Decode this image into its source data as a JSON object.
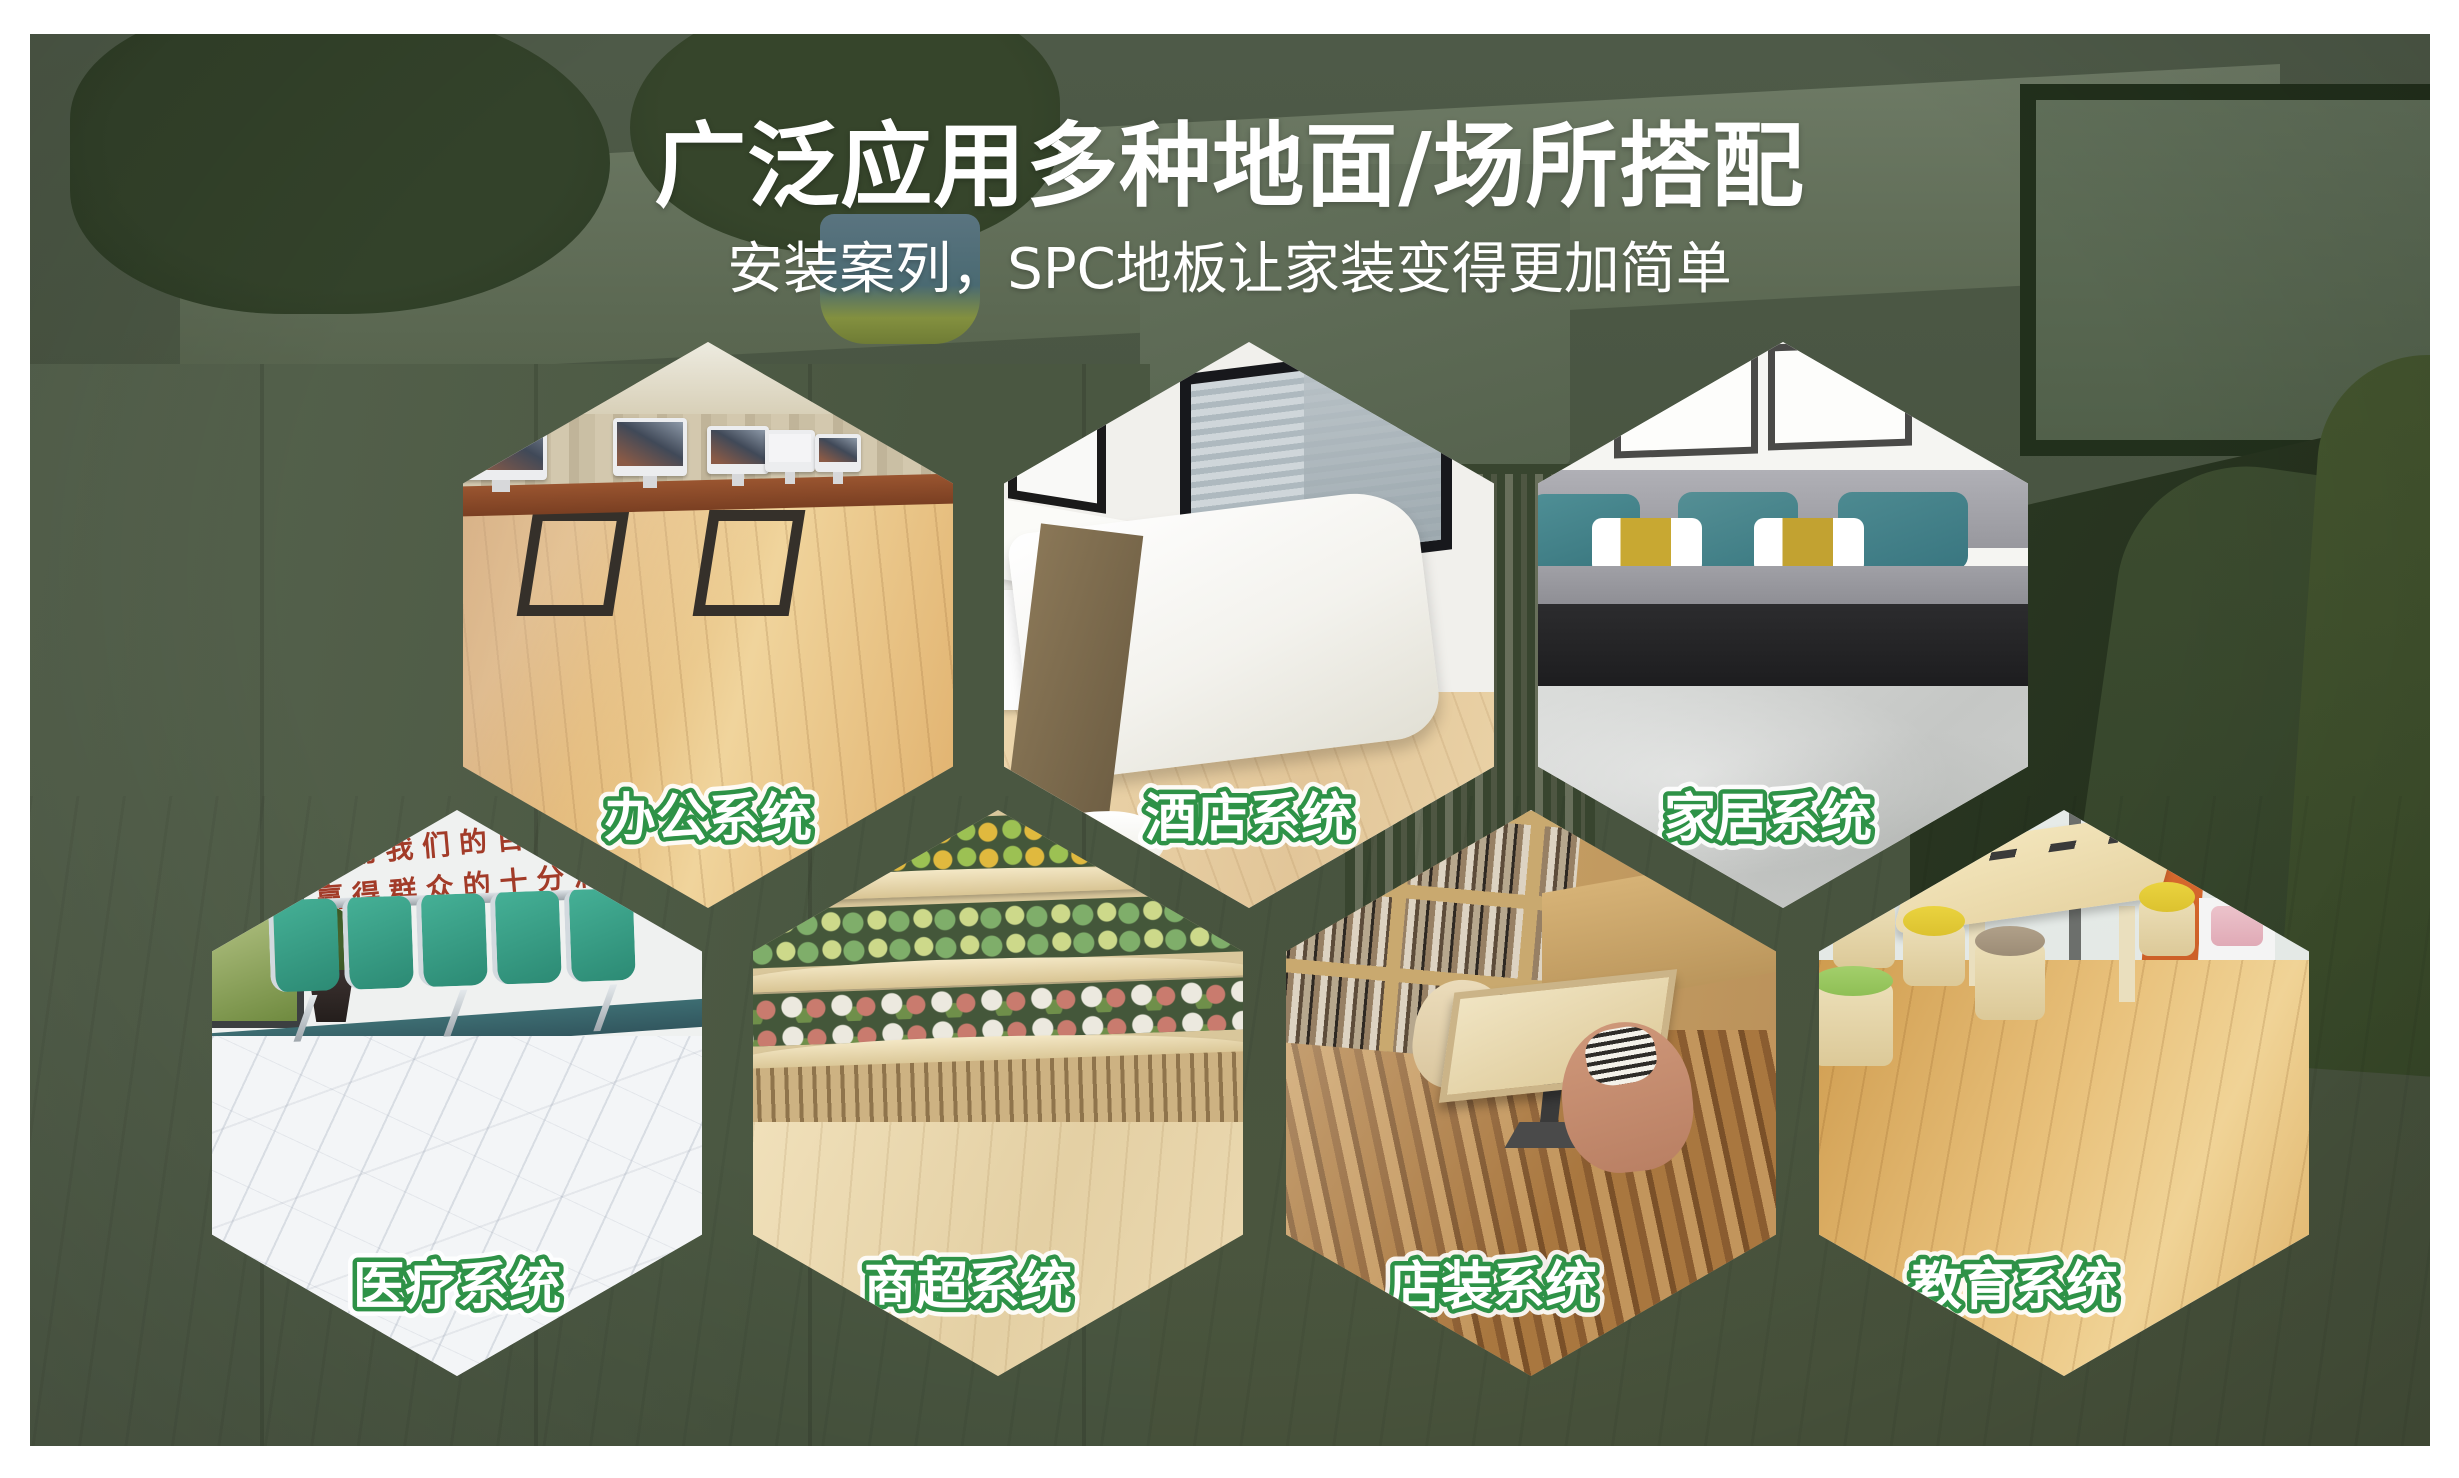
{
  "header": {
    "title": "广泛应用多种地面/场所搭配",
    "subtitle": "安装案列，SPC地板让家装变得更加简单"
  },
  "theme": {
    "page_margin_color": "#FFFFFF",
    "background_green": "#48543E",
    "title_color": "#FFFFFF",
    "label_text_color": "#FFFFFF",
    "label_outline_green": "#2E9247",
    "medical_slogan_red": "#A23B28"
  },
  "hexagons": [
    {
      "id": "office",
      "label": "办公系统",
      "scene": "open-plan office with desktop computers on golden wood floor"
    },
    {
      "id": "hotel",
      "label": "酒店系统",
      "scene": "hotel bedroom, white bed with brown runner on pale wood floor"
    },
    {
      "id": "home",
      "label": "家居系统",
      "scene": "living room, grey sofa with teal cushions on light grey floor"
    },
    {
      "id": "medical",
      "label": "医疗系统",
      "scene": "hospital waiting area, green bench row on white marble floor",
      "wall_slogan_line1": "用我们的百倍",
      "wall_slogan_line2": "赢得群众的十分满"
    },
    {
      "id": "supermarket",
      "label": "商超系统",
      "scene": "supermarket produce shelves on light wood floor"
    },
    {
      "id": "store",
      "label": "店装系统",
      "scene": "book cafe with shelves, table and chairs on parquet floor"
    },
    {
      "id": "education",
      "label": "教育系统",
      "scene": "kids classroom with round stools on oak floor"
    }
  ]
}
